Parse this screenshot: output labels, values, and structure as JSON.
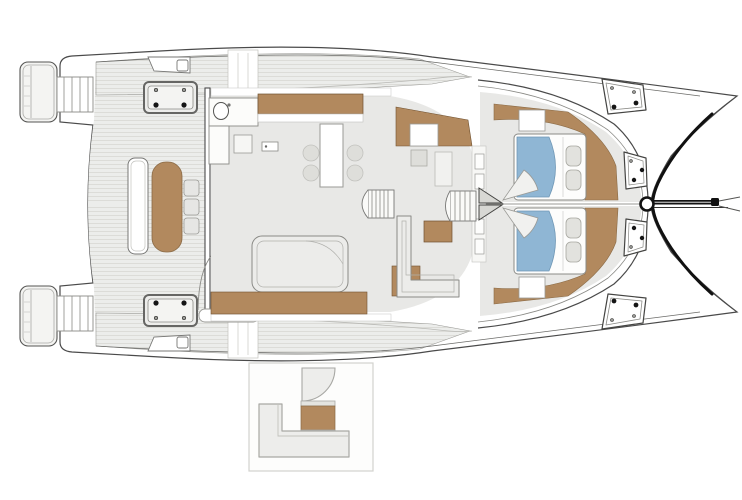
{
  "title": "Catamaran deck floor plan (top view)",
  "colors": {
    "outline": "#4a4a4a",
    "outline_light": "#9a9a96",
    "line_mid": "#8a8a86",
    "deck": "#ecedeb",
    "deck_stripe": "#dcdcd8",
    "floor": "#e8e8e6",
    "furniture": "#ececea",
    "panel": "#f4f4f2",
    "white": "#ffffff",
    "wood": "#b2895e",
    "wood_edge": "#8a6a45",
    "bed": "#8fb6d4",
    "bed_edge": "#6f97b5",
    "pillow": "#e2e2de",
    "pillow_edge": "#a6a69f",
    "hatch_dot": "#151515",
    "inset_border": "#d2d2ce",
    "inset_shape": "#ededeb",
    "inset_shape_edge": "#a8a8a4"
  },
  "counts": {
    "hulls": 2,
    "stern_platforms": 2,
    "side_deck_hatches": 2,
    "foredeck_hatches": 4,
    "cabins": 2,
    "double_beds": 2,
    "pillows_per_bed": 2,
    "salon_dining_chairs": 4,
    "cockpit_chairs": 3,
    "staircases": 4
  }
}
